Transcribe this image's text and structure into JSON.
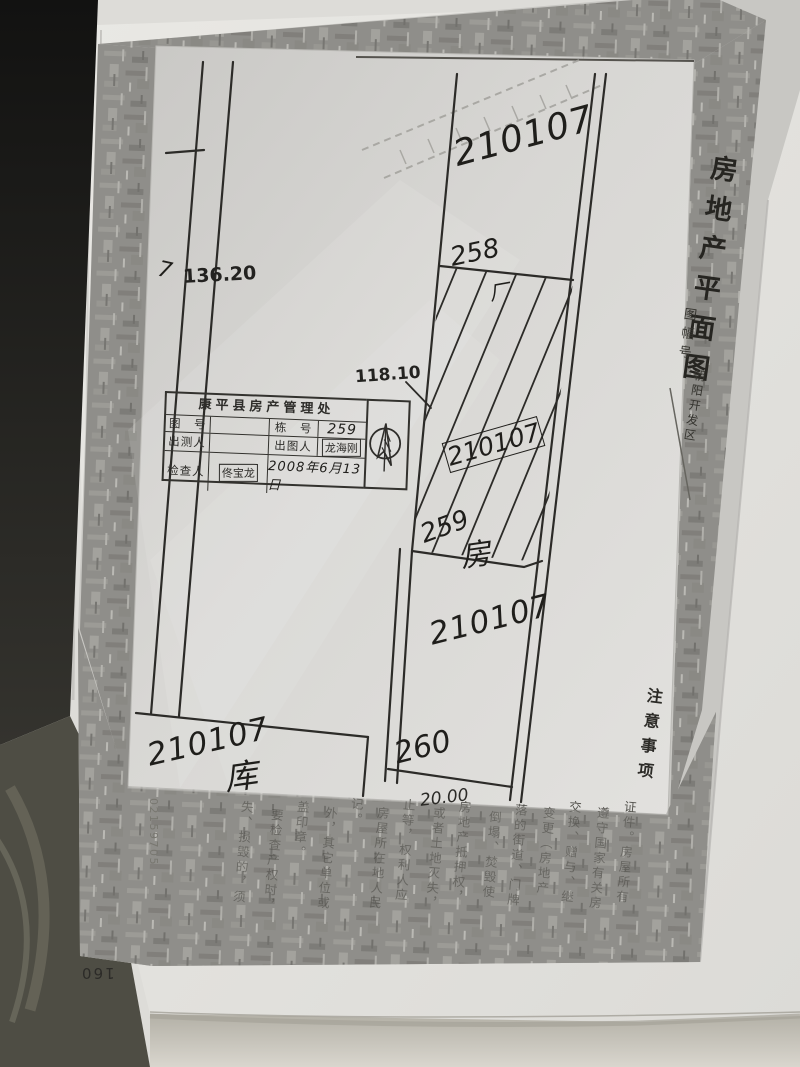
{
  "photo_page": {
    "page_number": "160",
    "serial_number": "02159705"
  },
  "title_block": {
    "title": "房地产平面图",
    "sheet_label": "图幅号",
    "sheet_value": "朝阳开发区"
  },
  "plan": {
    "dim_left": "136.20",
    "dim_mid": "118.10",
    "dim_bottom": "20.00",
    "mark_left": "7",
    "parcel_top": "210107",
    "boundary_258": "258",
    "mark_strip": "厂",
    "parcel_strip": "210107",
    "boundary_259": "259",
    "boundary_259_suffix": "房",
    "parcel_lower": "210107",
    "boundary_260": "260",
    "parcel_warehouse": "210107",
    "warehouse_suffix": "库"
  },
  "stamp": {
    "title": "康平县房产管理处",
    "row1": {
      "label1": "图　号",
      "value1": "",
      "label2": "栋　号",
      "value2": "259"
    },
    "row2": {
      "label1": "出测人",
      "value1": "",
      "label2": "出图人",
      "value2": "龙海刚"
    },
    "row3": {
      "label": "检查人",
      "value": "佟宝龙",
      "date": "2008年6月13日"
    }
  },
  "notes": {
    "heading": "注意事项",
    "columns": [
      "证件。房屋所有",
      "遵守国家有关房",
      "交换、赠与、继",
      "变更（房地产",
      "落的街道、门牌",
      "倒塌、焚毁使",
      "房地产抵押权，",
      "或者土地灭失，",
      "止等，权利人应",
      "房屋所在地人民",
      "记。",
      "外，其它单位或",
      "盖印章。",
      "要检查产权时，",
      "失、损毁的，须"
    ]
  }
}
